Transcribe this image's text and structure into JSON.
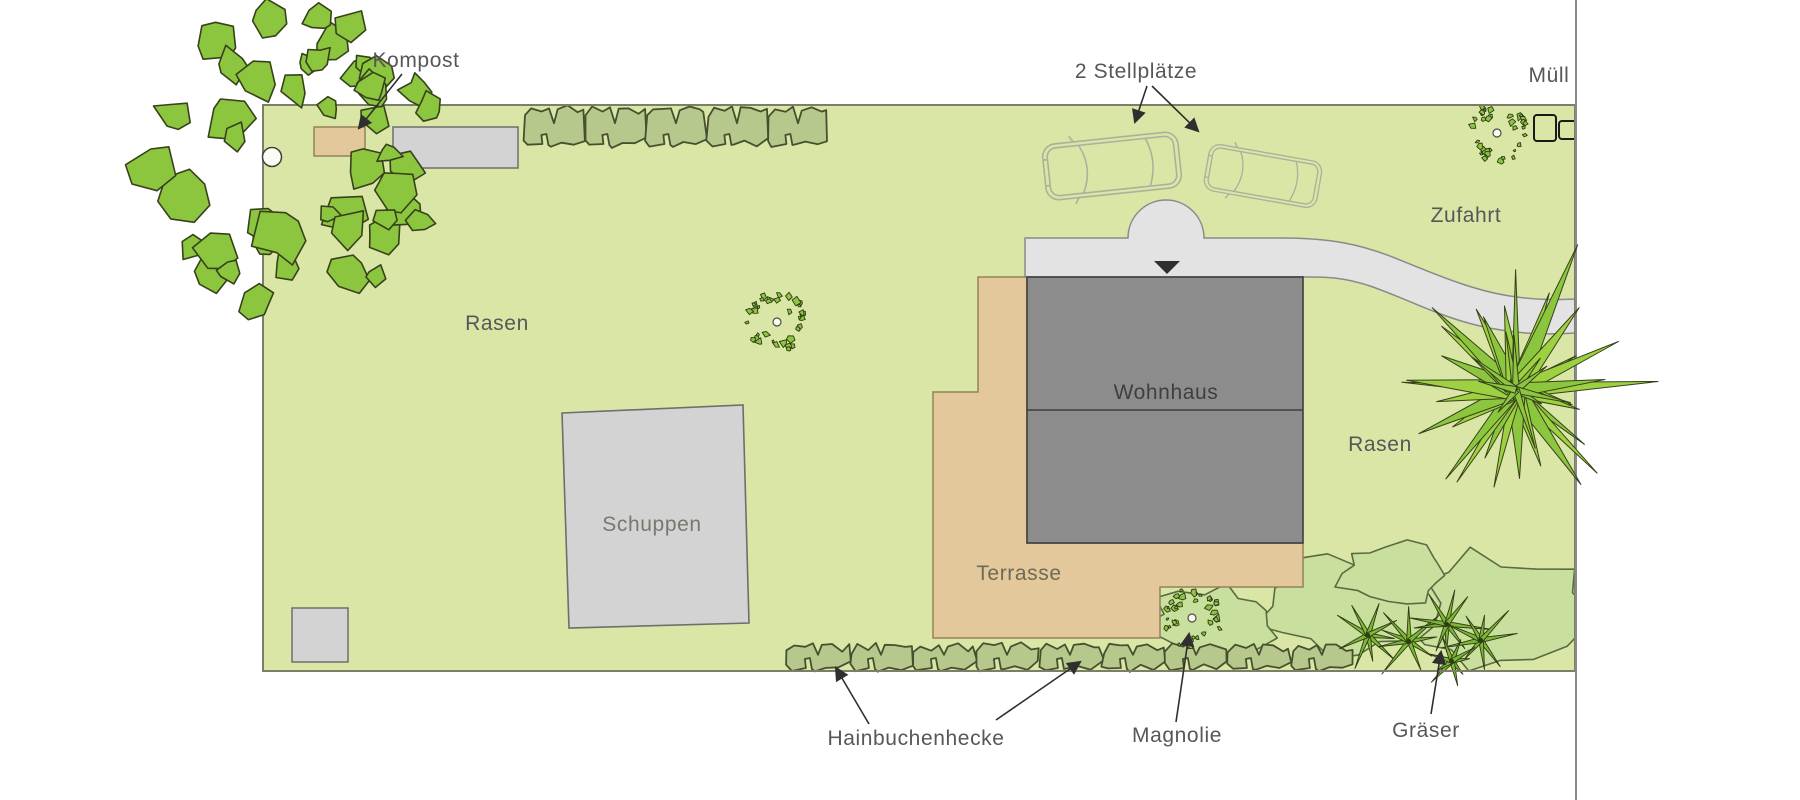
{
  "diagram": {
    "type": "garden-plan",
    "labels": {
      "kompost": "Kompost",
      "stellplaetze": "2 Stellplätze",
      "muell": "Müll",
      "zufahrt": "Zufahrt",
      "rasen_left": "Rasen",
      "rasen_right": "Rasen",
      "wohnhaus": "Wohnhaus",
      "schuppen": "Schuppen",
      "terrasse": "Terrasse",
      "hainbuchenhecke": "Hainbuchenhecke",
      "magnolie": "Magnolie",
      "graeser": "Gräser"
    },
    "colors": {
      "lawn": "#d9e6a6",
      "plot_border": "#7c7f68",
      "foliage": "#8cc63e",
      "foliage_alt": "#9ed141",
      "foliage_outline": "#37411c",
      "hedge": "#b6c88c",
      "hedge_outline": "#46502f",
      "bed": "#c8df9d",
      "bed_outline": "#5c6a42",
      "grass": "#7cb733",
      "grass_dark": "#2e3a17",
      "house": "#8c8c8c",
      "house_outline": "#3f3f3f",
      "gray_building": "#d3d3d3",
      "building_outline": "#6e6e6e",
      "driveway": "#e3e3e3",
      "driveway_outline": "#8a8a8a",
      "terrace": "#e3c89b",
      "terrace_outline": "#94825a",
      "label": "#56575a",
      "label_dark": "#3f3f3f",
      "label_mid": "#78786f",
      "label_terrace": "#6f6a55",
      "arrow": "#2f2f2f",
      "boundary": "#8a8a8a",
      "bin_outline": "#1a1a1a",
      "car": "#a9b29b",
      "trunk_fill": "#fbfdf4"
    }
  }
}
